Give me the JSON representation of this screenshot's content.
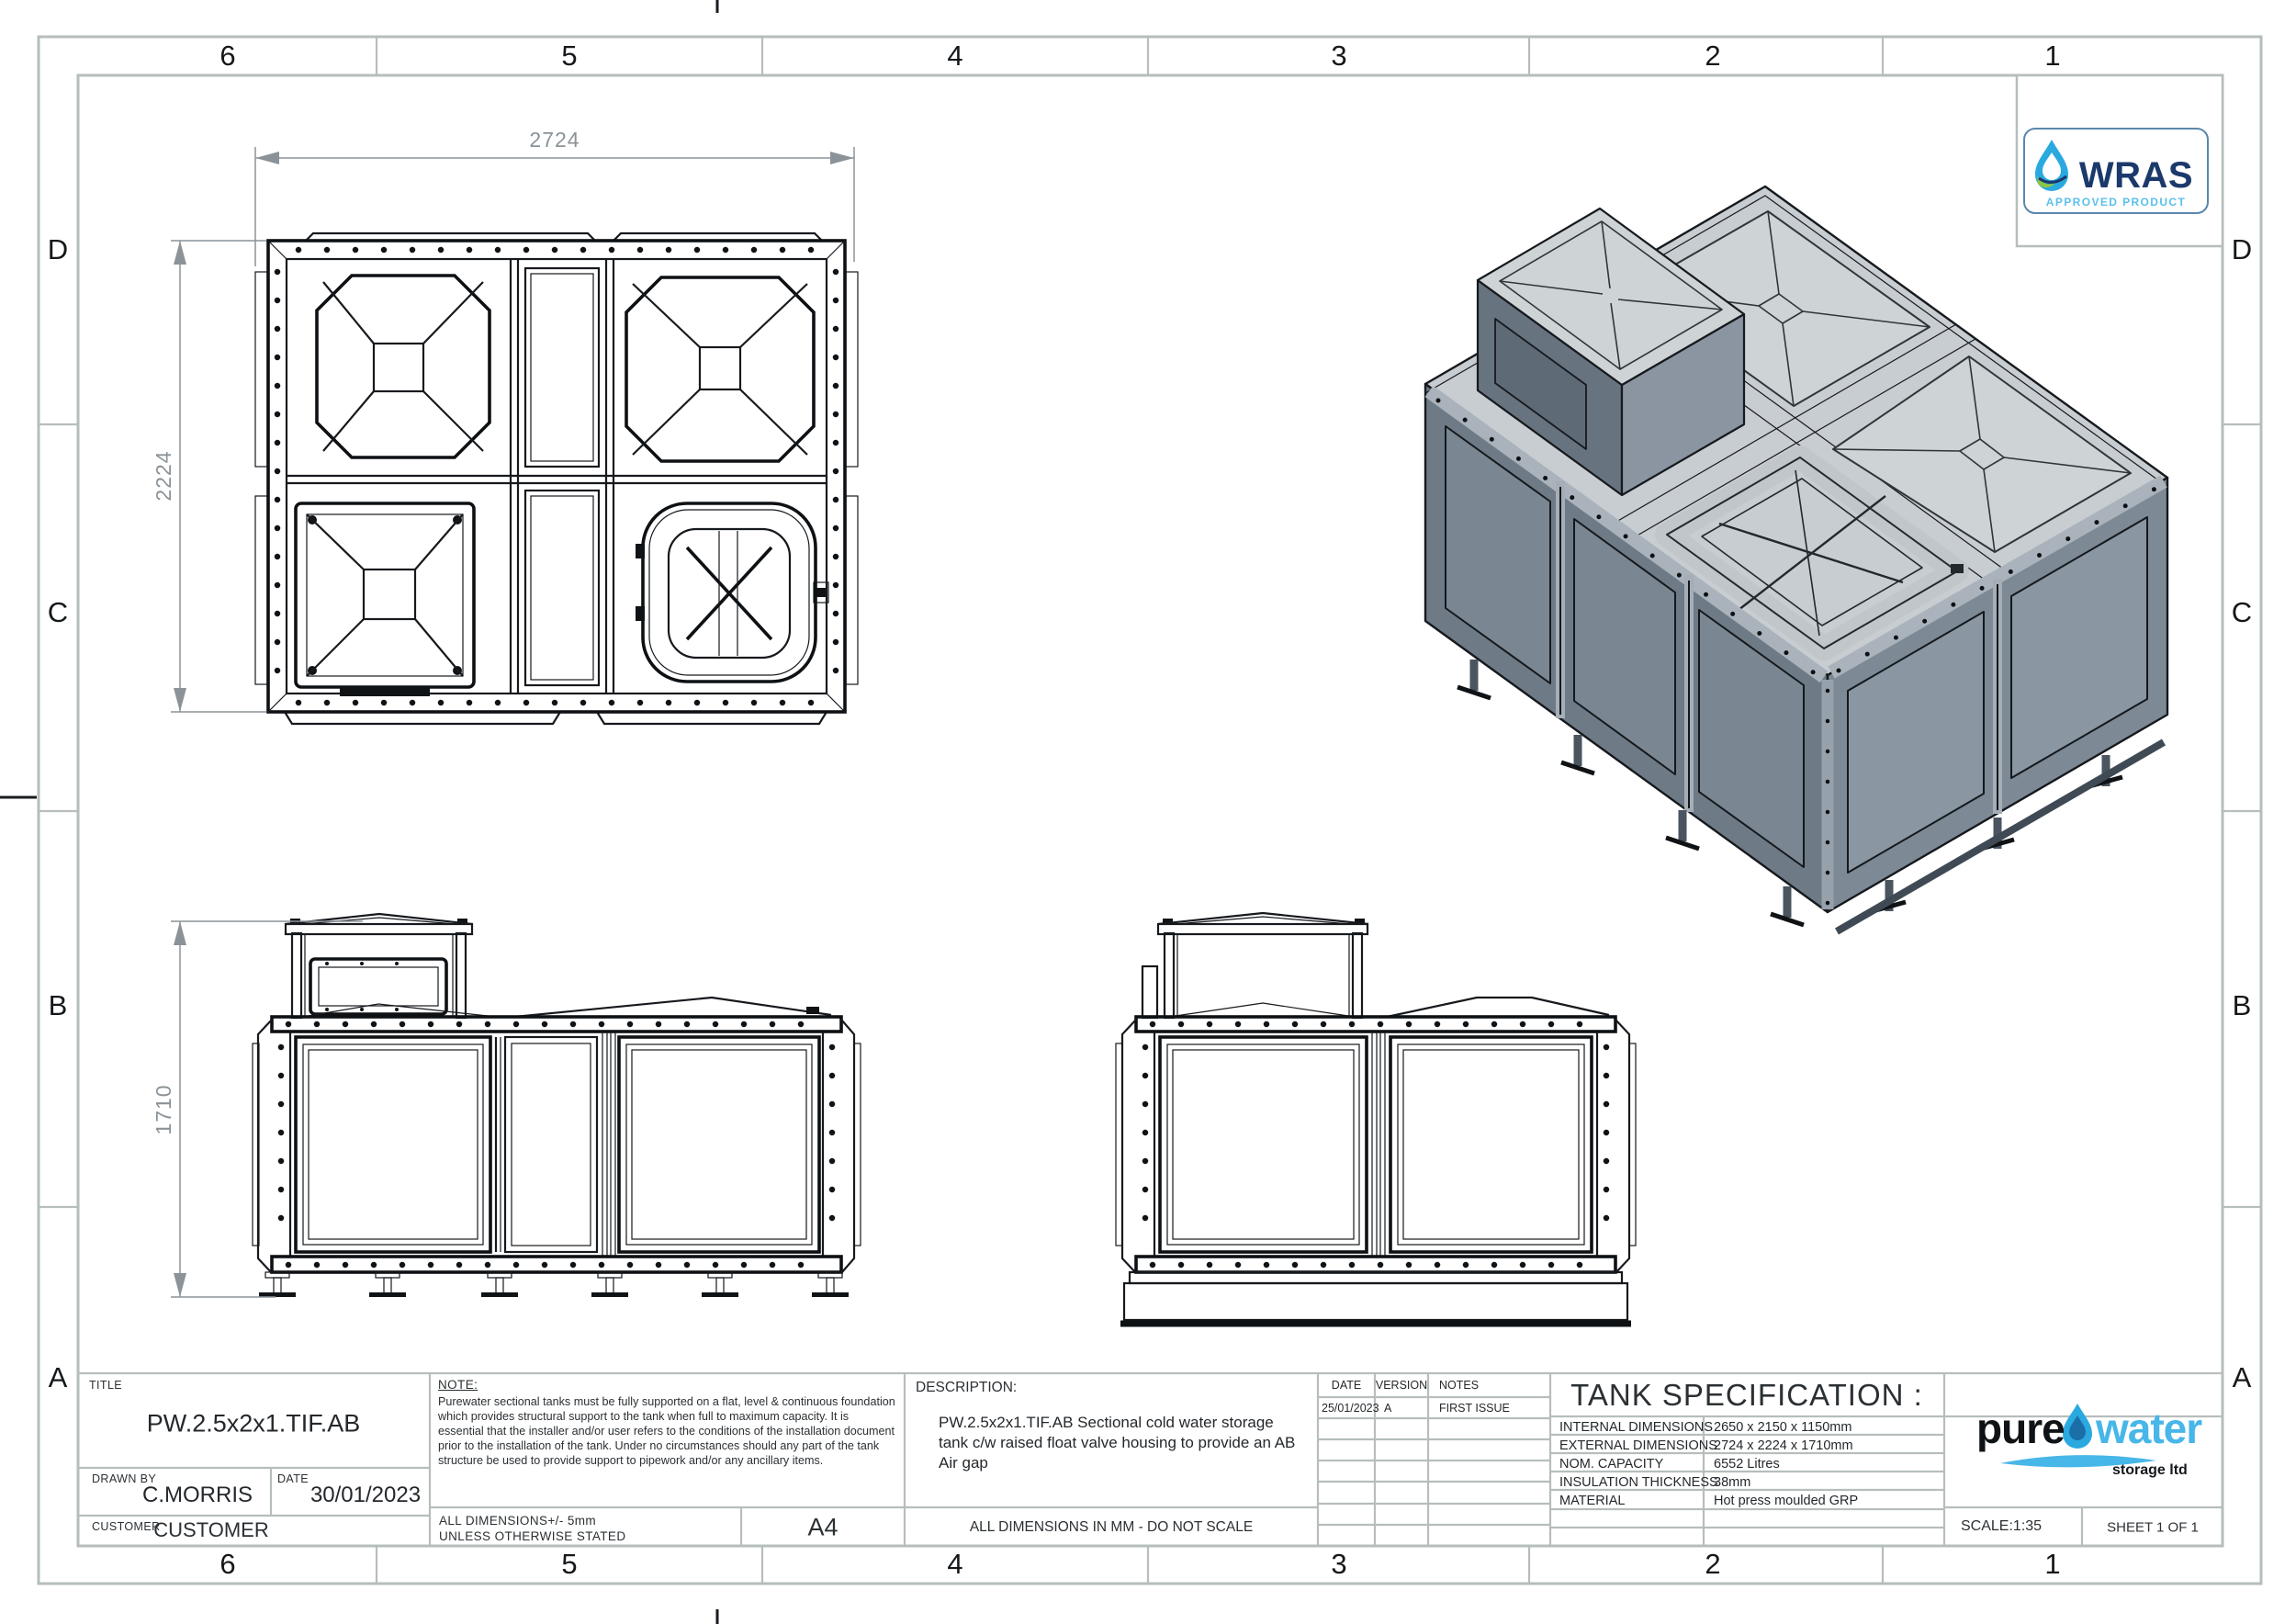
{
  "sheet": {
    "cols": [
      "6",
      "5",
      "4",
      "3",
      "2",
      "1"
    ],
    "rows": [
      "D",
      "C",
      "B",
      "A"
    ]
  },
  "dims": {
    "plan_width": "2724",
    "plan_depth": "2224",
    "height": "1710"
  },
  "wras": {
    "name": "WRAS",
    "subtitle": "APPROVED PRODUCT"
  },
  "title_block": {
    "title_label": "TITLE",
    "title": "PW.2.5x2x1.TIF.AB",
    "drawn_by_label": "DRAWN BY",
    "drawn_by": "C.MORRIS",
    "date_label": "DATE",
    "date": "30/01/2023",
    "customer_label": "CUSTOMER",
    "customer": "CUSTOMER",
    "note_label": "NOTE:",
    "note_text": "Purewater sectional tanks must be fully supported on a flat, level & continuous foundation which provides structural support to the tank when full to maximum capacity. It is essential that the installer and/or user refers to the conditions of the installation document prior to the installation of the tank. Under no circumstances should any part of the tank structure be used to provide support to pipework and/or any ancillary items.",
    "tolerance_line1": "ALL DIMENSIONS+/- 5mm",
    "tolerance_line2": "UNLESS OTHERWISE STATED",
    "paper_size": "A4",
    "description_label": "DESCRIPTION:",
    "description": "PW.2.5x2x1.TIF.AB Sectional cold water storage tank c/w raised float valve housing to provide an AB Air gap",
    "dims_note": "ALL DIMENSIONS IN MM - DO NOT SCALE",
    "revision_headers": [
      "DATE",
      "VERSION",
      "NOTES"
    ],
    "revision": {
      "date": "25/01/2023",
      "version": "A",
      "notes": "FIRST ISSUE"
    },
    "spec_title": "TANK SPECIFICATION :",
    "spec_rows": [
      {
        "label": "INTERNAL DIMENSIONS",
        "value": "2650 x 2150 x 1150mm"
      },
      {
        "label": "EXTERNAL DIMENSIONS",
        "value": "2724 x 2224 x 1710mm"
      },
      {
        "label": "NOM. CAPACITY",
        "value": "6552 Litres"
      },
      {
        "label": "INSULATION THICKNESS",
        "value": "38mm"
      },
      {
        "label": "MATERIAL",
        "value": "Hot press moulded GRP"
      }
    ],
    "scale": "SCALE:1:35",
    "sheet_no": "SHEET 1 OF 1",
    "logo": {
      "part1": "pure",
      "part2": "water",
      "part3": "storage ltd"
    }
  },
  "colors": {
    "frame_gray": "#b6bebc",
    "dim_gray": "#8b9398",
    "line_black": "#16191d",
    "wras_navy": "#1b3a6b",
    "wras_light_blue": "#5bc0eb",
    "droplet_blue": "#2aa9e0",
    "leaf_green": "#8dc63f",
    "logo_water_blue": "#47b6e8",
    "iso_top": "#c8cdd1",
    "iso_left": "#6e7a86",
    "iso_right": "#7d8995",
    "iso_roof_panel": "#ced3d6"
  }
}
